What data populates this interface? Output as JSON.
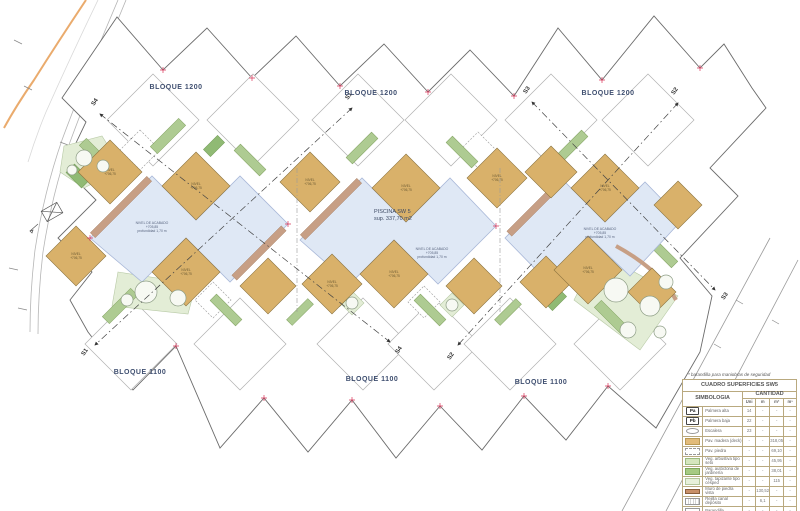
{
  "plan": {
    "bloque_1200": "BLOQUE 1200",
    "bloque_1100": "BLOQUE 1100",
    "piscina": {
      "l1": "PISCINA SW 5",
      "l2": "sup. 337,70 m2"
    },
    "pool_note": {
      "l1": "NIVEL DE ACABADO",
      "l2": "+705,85",
      "l3": "profundidad 1,70 m"
    },
    "deck_label": {
      "l1": "NIVEL",
      "l2": "+706,75"
    },
    "sections": {
      "s1": "S1",
      "s2": "S2",
      "s3": "S3",
      "s4": "S4"
    }
  },
  "legend": {
    "footnote": "* barandilla para maniobras de seguridad",
    "title": "CUADRO SUPERFICIES SW5",
    "col_simbologia": "SIMBOLOGIA",
    "col_cantidad": "CANTIDAD",
    "units": [
      "Uni",
      "m",
      "m²",
      "m³"
    ],
    "rows": [
      {
        "sym": "pa",
        "sym_text": "Pa",
        "name": "Palmera alta",
        "uni": "14",
        "m": "-",
        "m2": "-",
        "m3": "-"
      },
      {
        "sym": "pb",
        "sym_text": "Pb",
        "name": "Palmera baja",
        "uni": "22",
        "m": "-",
        "m2": "-",
        "m3": "-"
      },
      {
        "sym": "oval",
        "sym_text": "",
        "name": "Escalera",
        "uni": "23",
        "m": "-",
        "m2": "-",
        "m3": "-"
      },
      {
        "sym": "wood",
        "sym_text": "",
        "name": "Pav. madera (deck)",
        "uni": "-",
        "m": "-",
        "m2": "318,05",
        "m3": "-"
      },
      {
        "sym": "stone",
        "sym_text": "",
        "name": "Pav. piedra",
        "uni": "-",
        "m": "-",
        "m2": "69,10",
        "m3": "-"
      },
      {
        "sym": "hedge",
        "sym_text": "",
        "name": "Veg. arbustiva tipo seto",
        "uni": "-",
        "m": "-",
        "m2": "45,95",
        "m3": "-"
      },
      {
        "sym": "garden",
        "sym_text": "",
        "name": "Veg. autóctona de jardinería",
        "uni": "-",
        "m": "-",
        "m2": "38,01",
        "m3": "-"
      },
      {
        "sym": "grass",
        "sym_text": "",
        "name": "Veg. tapizante tipo césped",
        "uni": "-",
        "m": "-",
        "m2": "115",
        "m3": "-"
      },
      {
        "sym": "wall",
        "sym_text": "",
        "name": "Muro de piedra vista",
        "uni": "-",
        "m": "130,52",
        "m2": "-",
        "m3": "-"
      },
      {
        "sym": "grid",
        "sym_text": "",
        "name": "Rejilla canal depósito",
        "uni": "-",
        "m": "6,1",
        "m2": "-",
        "m3": "-"
      },
      {
        "sym": "rail",
        "sym_text": "",
        "name": "Barandilla",
        "uni": "-",
        "m": "-",
        "m2": "-",
        "m3": "-"
      }
    ]
  },
  "colors": {
    "deck_wood": "#d9b16a",
    "pool_water": "#dfe8f5",
    "hedge_green": "#aecb92",
    "garden_green": "#90ba74",
    "grass_green": "#e3edd6",
    "stone_wall": "#c79f85",
    "road_orange": "#eaab6d",
    "marker_red": "#d9365a",
    "label_blue": "#3f4f70"
  }
}
